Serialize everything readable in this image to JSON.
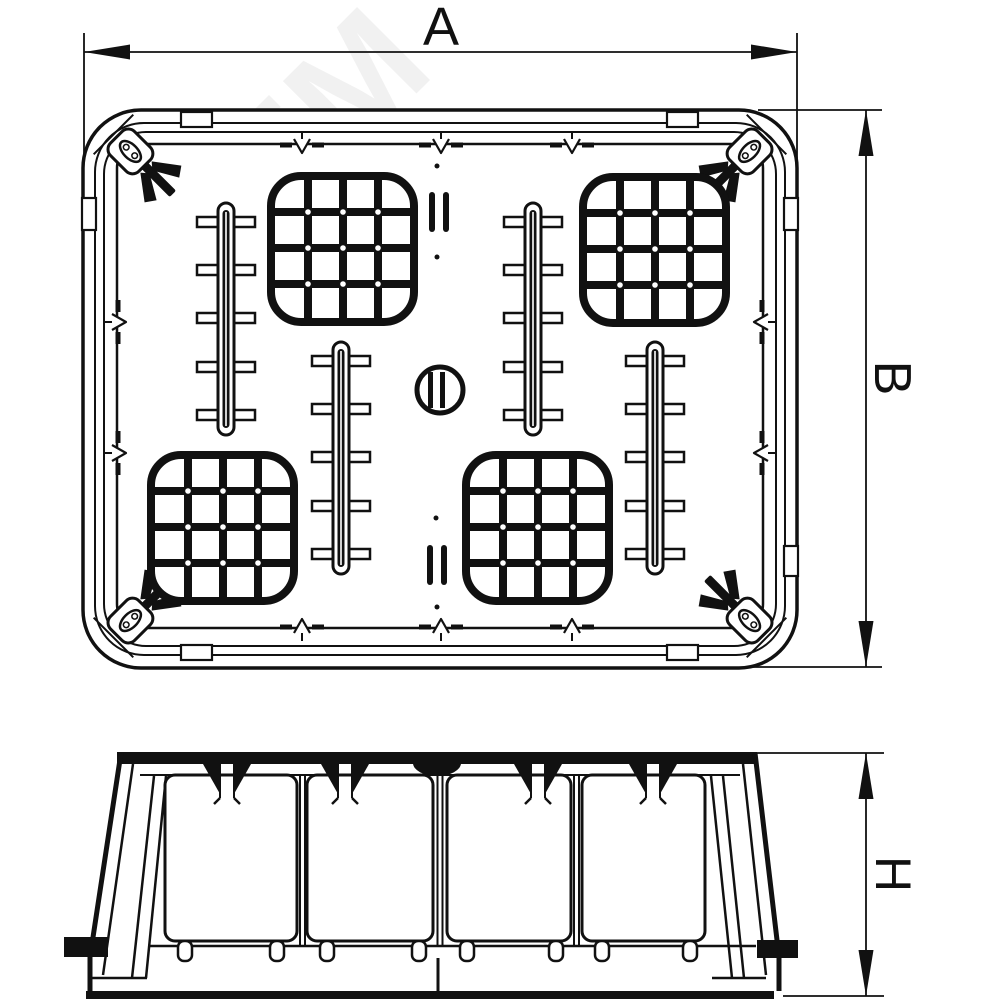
{
  "drawing": {
    "dims": {
      "a": "A",
      "b": "B",
      "h": "H"
    },
    "watermark": {
      "text": "ЭТМ"
    },
    "colors": {
      "line": "#111111",
      "background": "#ffffff"
    }
  }
}
